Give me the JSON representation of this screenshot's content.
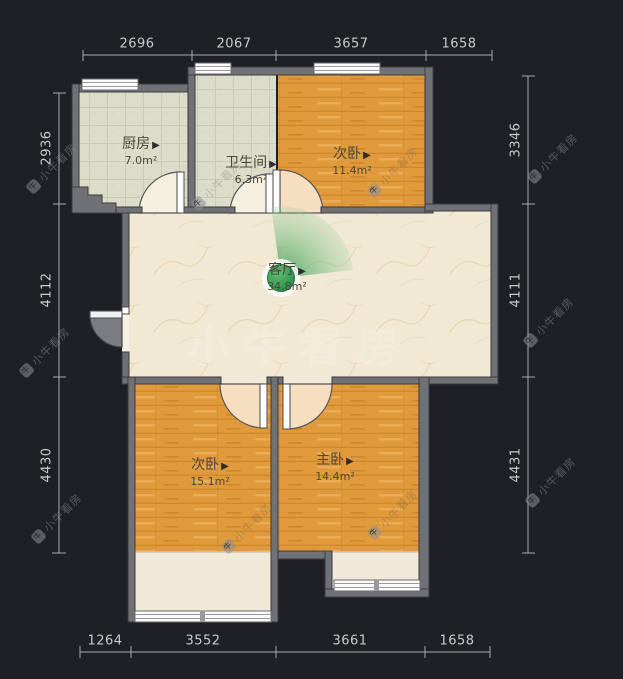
{
  "plan_title": "户型图",
  "rooms": {
    "kitchen": {
      "name": "厨房",
      "area": "7.0m²"
    },
    "bathroom": {
      "name": "卫生间",
      "area": "6.3m²"
    },
    "bedroom_top": {
      "name": "次卧",
      "area": "11.4m²"
    },
    "living": {
      "name": "客厅",
      "area": "34.8m²"
    },
    "bedroom_left": {
      "name": "次卧",
      "area": "15.1m²"
    },
    "master": {
      "name": "主卧",
      "area": "14.4m²"
    }
  },
  "ui": {
    "room_arrow": "▶"
  },
  "dimensions": {
    "top": [
      "2696",
      "2067",
      "3657",
      "1658"
    ],
    "bottom": [
      "1264",
      "3552",
      "3661",
      "1658"
    ],
    "left": [
      "2936",
      "4112",
      "4430"
    ],
    "right": [
      "3346",
      "4111",
      "4431"
    ]
  },
  "watermark": {
    "text": "小牛看房",
    "icon_glyph": "牛"
  },
  "colors": {
    "background": "#1e2023",
    "wall": "#707175",
    "wood_floor": "#e19a3b",
    "tile_floor": "#dcddc9",
    "living_floor": "#f2e9d4",
    "camera_green": "#2f9448",
    "dimension_text": "#c9cacc"
  }
}
